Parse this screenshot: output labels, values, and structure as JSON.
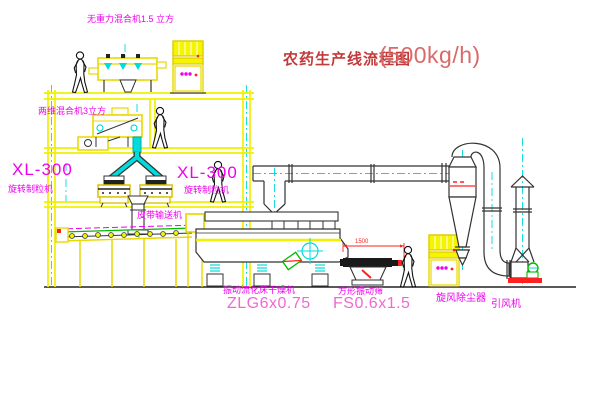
{
  "title": {
    "name_zh": "农药生产线流程图",
    "capacity": "(500kg/h)"
  },
  "labels": {
    "top_mixer": "无重力混合机1.5 立方",
    "floor2_mixer": "两维混合机3立方",
    "granulator_left_model": "XL-300",
    "granulator_left_name": "旋转制粒机",
    "granulator_center_model": "XL-300",
    "granulator_center_name": "旋转制粒机",
    "belt_conveyor": "皮带输送机",
    "dryer_name": "振动流化床干燥机",
    "dryer_model": "ZLG6x0.75",
    "sieve_name": "方形振动筛",
    "sieve_model": "FS0.6x1.5",
    "cyclone": "旋风除尘器",
    "fan": "引风机",
    "sieve_dim": "1500"
  },
  "colors": {
    "background": "#ffffff",
    "line_yellow": "#f0f000",
    "line_cyan": "#00dcdc",
    "line_dark": "#333333",
    "label_magenta": "#ee00ee",
    "model_pink": "#f068d2",
    "title_red": "#c23a3a",
    "dim_red": "#ff2020",
    "green": "#00bb00"
  }
}
